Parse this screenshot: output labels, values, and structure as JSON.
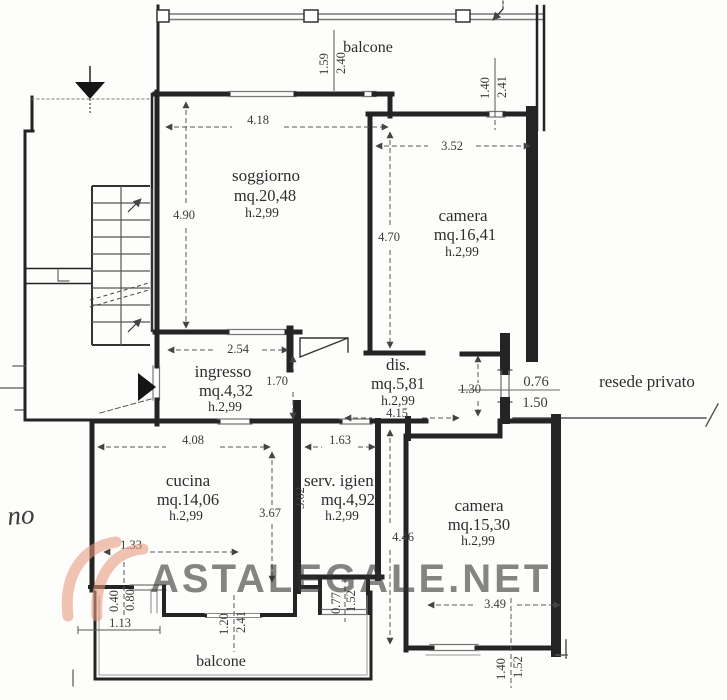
{
  "watermark": {
    "text": "ASTALEGALE.NET",
    "color": "#e8997f"
  },
  "margin_note": {
    "text": "no"
  },
  "areas": {
    "balcone_top": {
      "name": "balcone"
    },
    "balcone_sud": {
      "name": "balcone"
    },
    "resede": {
      "name": "resede privato"
    },
    "soggiorno": {
      "name": "soggiorno",
      "area": "mq.20,48",
      "height": "h.2,99"
    },
    "camera_nord": {
      "name": "camera",
      "area": "mq.16,41",
      "height": "h.2,99"
    },
    "ingresso": {
      "name": "ingresso",
      "area": "mq.4,32",
      "height": "h.2,99"
    },
    "dis": {
      "name": "dis.",
      "area": "mq.5,81",
      "height": "h.2,99"
    },
    "cucina": {
      "name": "cucina",
      "area": "mq.14,06",
      "height": "h.2,99"
    },
    "serv_igien": {
      "name": "serv. igien.",
      "area": "mq.4,92",
      "height": "h.2,99"
    },
    "camera_sud": {
      "name": "camera",
      "area": "mq.15,30",
      "height": "h.2,99"
    }
  },
  "dims": {
    "balcone_top_w": "1.59",
    "balcone_top_d": "2.40",
    "finestra_ne_w": "1.40",
    "finestra_ne_d": "2.41",
    "soggiorno_w": "4.18",
    "soggiorno_d": "4.90",
    "camera_nord_w": "3.52",
    "camera_nord_d": "4.70",
    "ingresso_w": "2.54",
    "ingresso_d": "1.70",
    "dis_l": "4.15",
    "passage_d": "1.30",
    "porta_resede_w": "0.76",
    "porta_resede_d": "1.50",
    "cucina_w": "4.08",
    "cucina_d": "3.67",
    "cucina_fin_off": "1.33",
    "fin_cucina_w": "0.40",
    "fin_cucina_d": "0.80",
    "davanzale": "1.13",
    "serv_w": "1.63",
    "serv_d": "3.02",
    "fin_serv_w": "0.77",
    "fin_serv_d": "1.52",
    "camera_sud_d": "4.46",
    "camera_sud_w": "3.49",
    "fin_camera_sud_w": "1.40",
    "fin_camera_sud_d": "1.52",
    "porta_balcone_w": "1.20",
    "porta_balcone_d": "2.41"
  }
}
